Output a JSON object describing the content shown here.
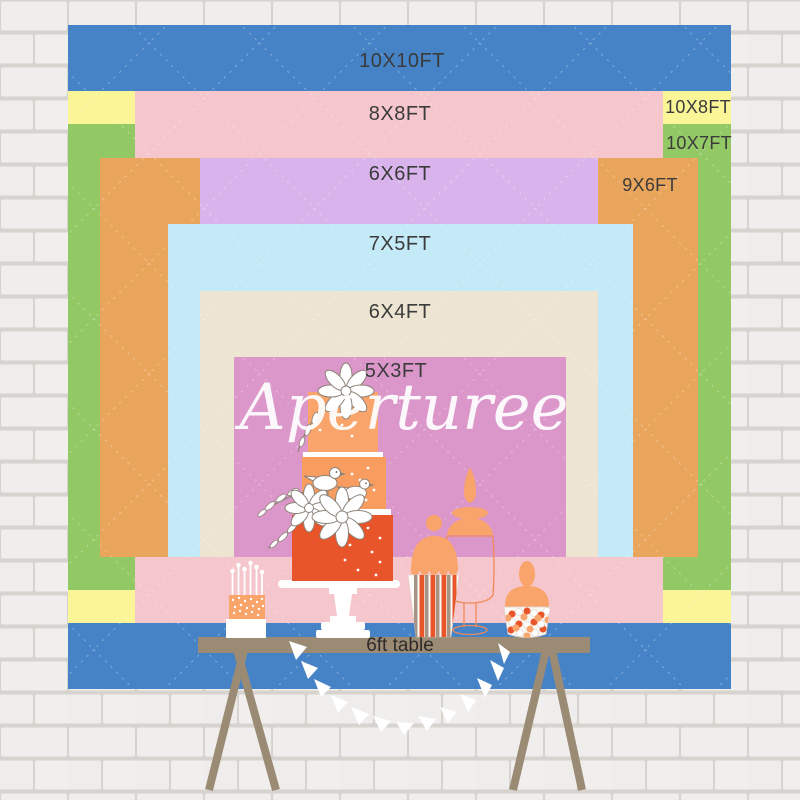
{
  "palette": {
    "label_text": "#3b3b3b",
    "watermark": "#ffffff",
    "wall_brick": "#efeeec",
    "wall_mortar": "#d7d4d0",
    "diamond_line": "#ffffff"
  },
  "backdrop": {
    "watermark": "Aperturee",
    "sizes": [
      {
        "id": "10x10",
        "label": "10X10FT",
        "color": "#4583c6"
      },
      {
        "id": "10x8",
        "label": "10X8FT",
        "color": "#faf596"
      },
      {
        "id": "10x7",
        "label": "10X7FT",
        "color": "#92c965"
      },
      {
        "id": "8x8",
        "label": "8X8FT",
        "color": "#f5c6cb"
      },
      {
        "id": "9x6",
        "label": "9X6FT",
        "color": "#eaa55c"
      },
      {
        "id": "6x6",
        "label": "6X6FT",
        "color": "#d9b4ec"
      },
      {
        "id": "7x5",
        "label": "7X5FT",
        "color": "#c4eaf8"
      },
      {
        "id": "6x4",
        "label": "6X4FT",
        "color": "#ede5d2"
      },
      {
        "id": "5x3",
        "label": "5X3FT",
        "color": "#db96ca"
      }
    ]
  },
  "illustration": {
    "table": {
      "label": "6ft table",
      "color": "#9b8a74"
    },
    "cake": {
      "tier_top": "#f9a46b",
      "tier_middle": "#f89c60",
      "tier_bottom": "#e9552b"
    },
    "accents": {
      "peach": "#f9a46b",
      "red_orange": "#e9552b",
      "taupe_stripe": "#a39483",
      "outline_orange": "#ef8a58",
      "sketch_gray": "#8d8378"
    }
  }
}
